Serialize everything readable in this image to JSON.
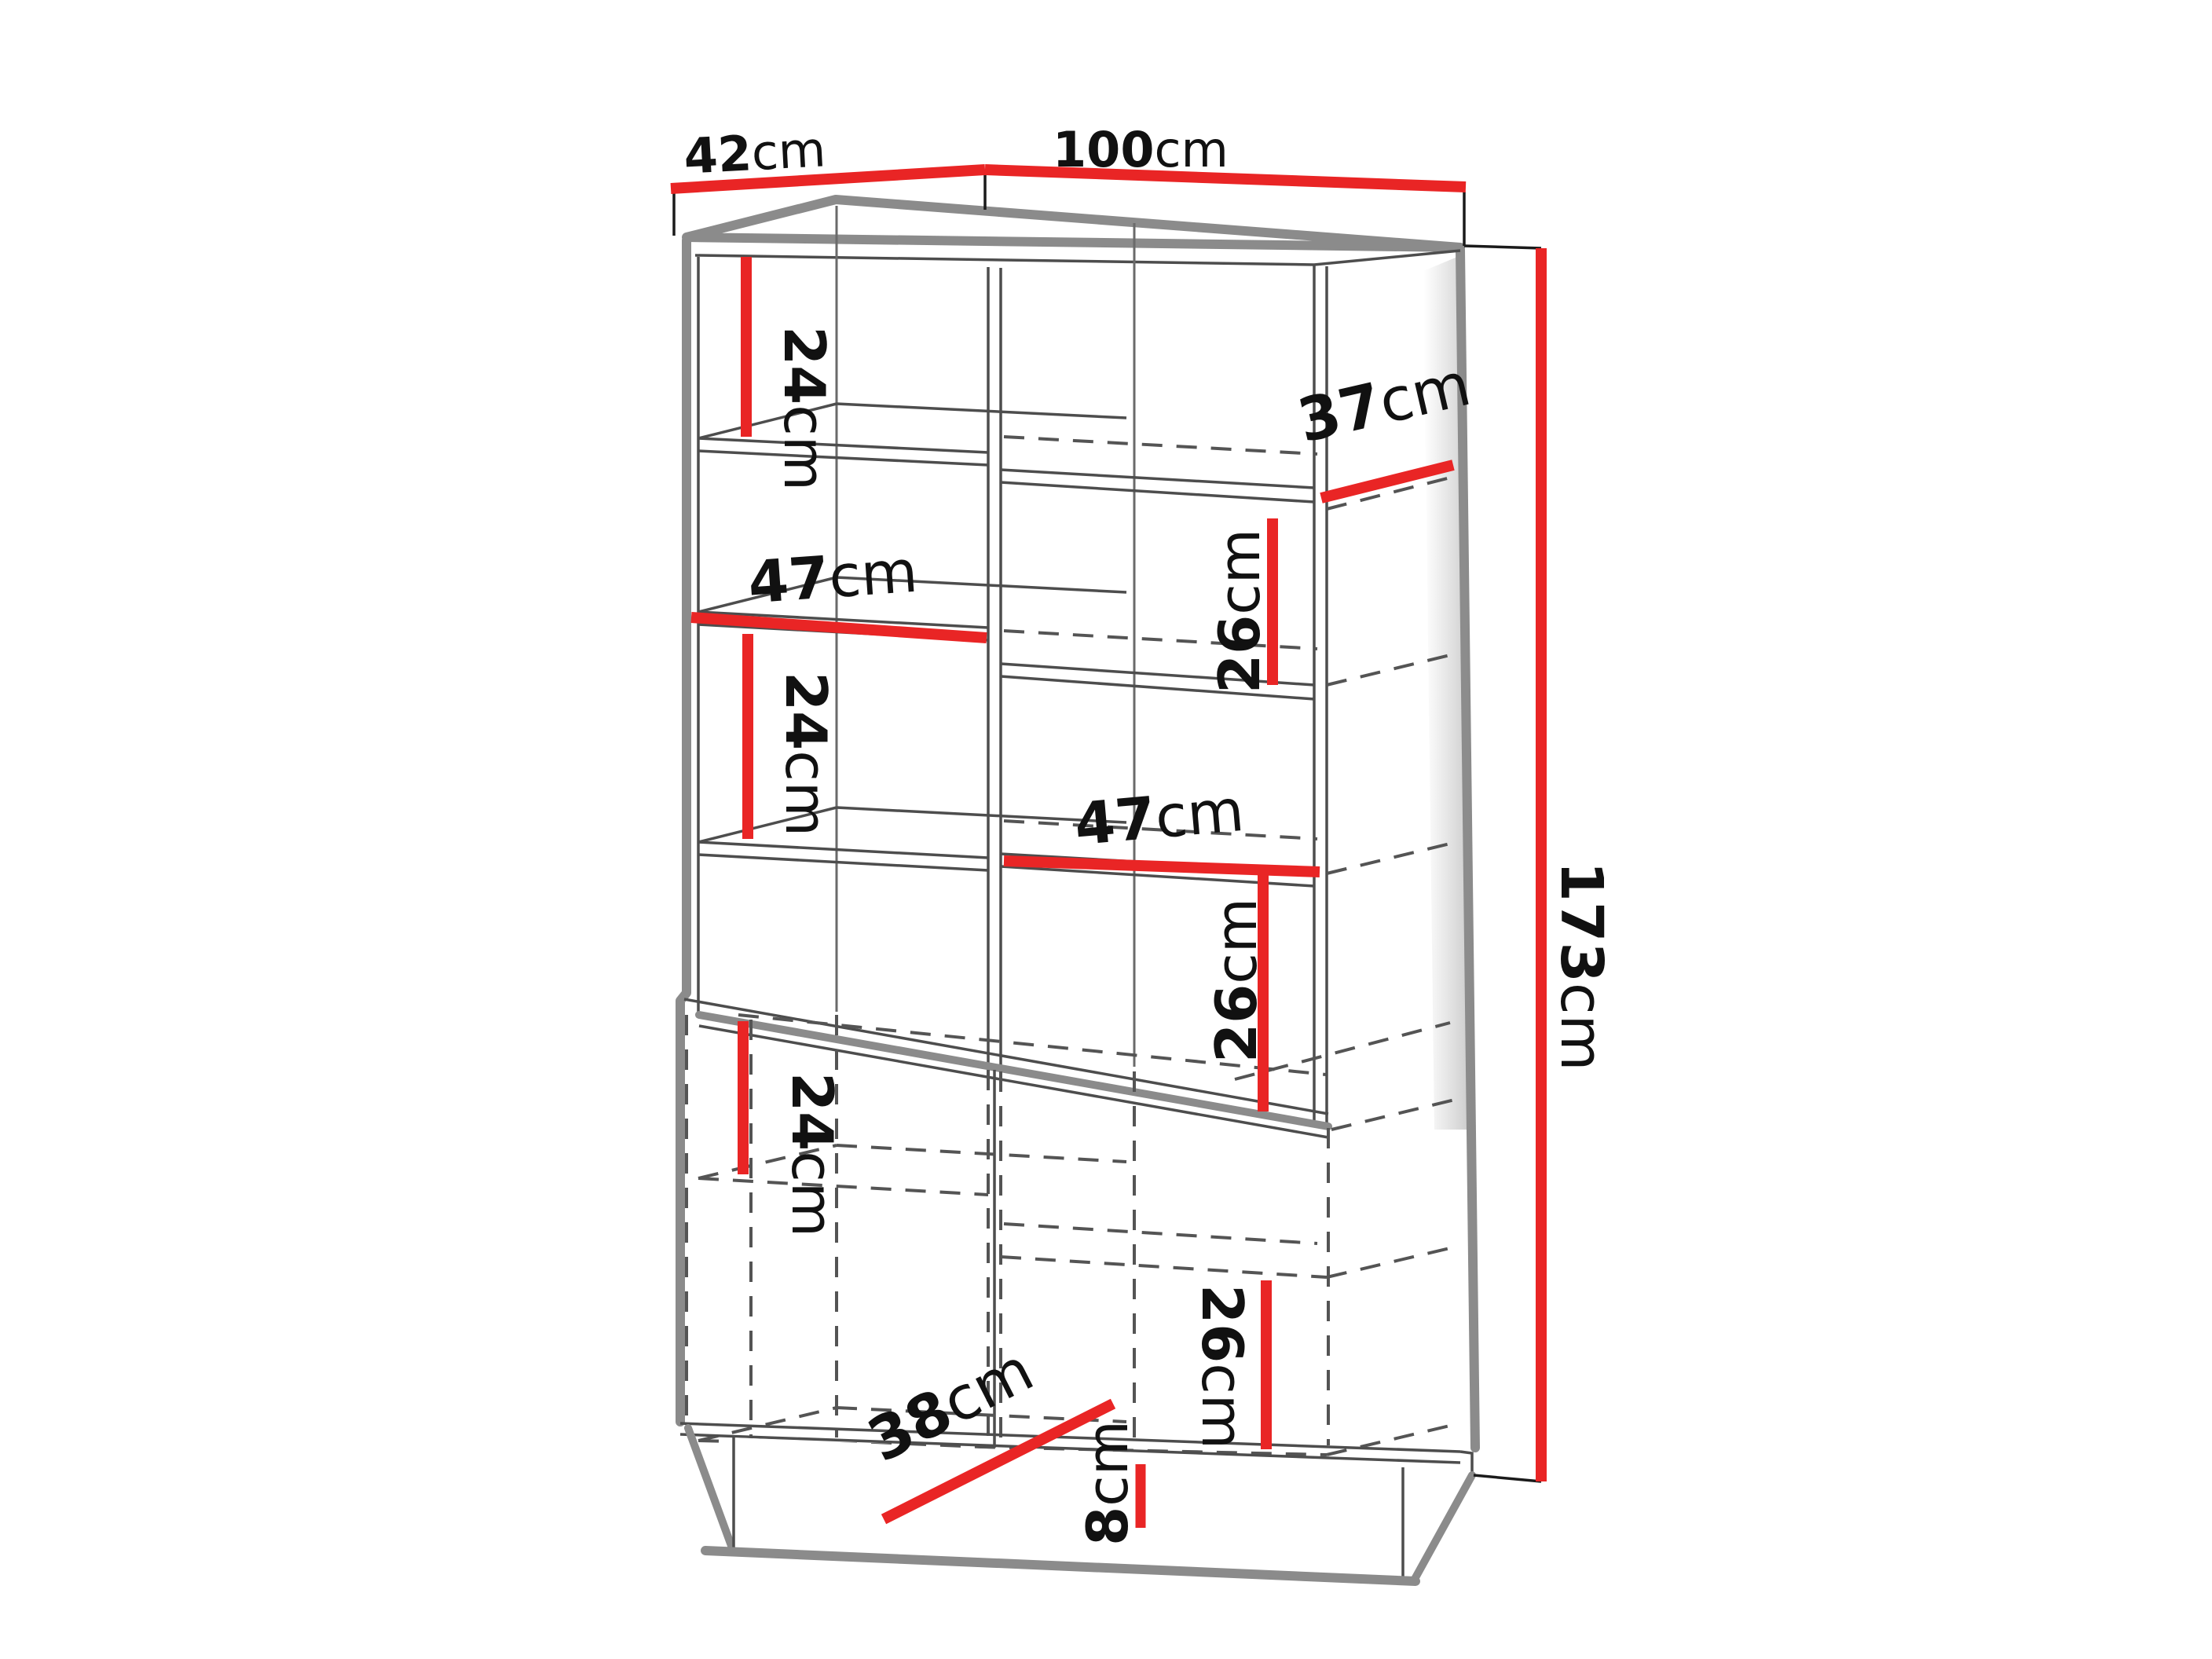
{
  "page": {
    "type": "furniture-dimension-diagram",
    "subject": "display cabinet with shelves and lower doors",
    "background": "#ffffff"
  },
  "colors": {
    "dimension_red": "#e92525",
    "edge_gray": "#8b8b8b",
    "line_dark": "#4d4d4d",
    "text": "#111111"
  },
  "dims": {
    "d42": {
      "value": "42",
      "unit": "cm",
      "meaning": "top depth"
    },
    "d100": {
      "value": "100",
      "unit": "cm",
      "meaning": "total width"
    },
    "d173": {
      "value": "173",
      "unit": "cm",
      "meaning": "total height"
    },
    "d37": {
      "value": "37",
      "unit": "cm",
      "meaning": "upper shelf depth"
    },
    "d24a": {
      "value": "24",
      "unit": "cm",
      "meaning": "top left compartment height"
    },
    "d26a": {
      "value": "26",
      "unit": "cm",
      "meaning": "upper right compartment height"
    },
    "d47a": {
      "value": "47",
      "unit": "cm",
      "meaning": "left inner width"
    },
    "d24b": {
      "value": "24",
      "unit": "cm",
      "meaning": "middle left compartment height"
    },
    "d47b": {
      "value": "47",
      "unit": "cm",
      "meaning": "right inner width"
    },
    "d26b": {
      "value": "26",
      "unit": "cm",
      "meaning": "lower right open compartment height"
    },
    "d24c": {
      "value": "24",
      "unit": "cm",
      "meaning": "door section left compartment height"
    },
    "d26c": {
      "value": "26",
      "unit": "cm",
      "meaning": "door section right compartment height"
    },
    "d38": {
      "value": "38",
      "unit": "cm",
      "meaning": "lower section depth"
    },
    "d8": {
      "value": "8",
      "unit": "cm",
      "meaning": "plinth height"
    }
  }
}
